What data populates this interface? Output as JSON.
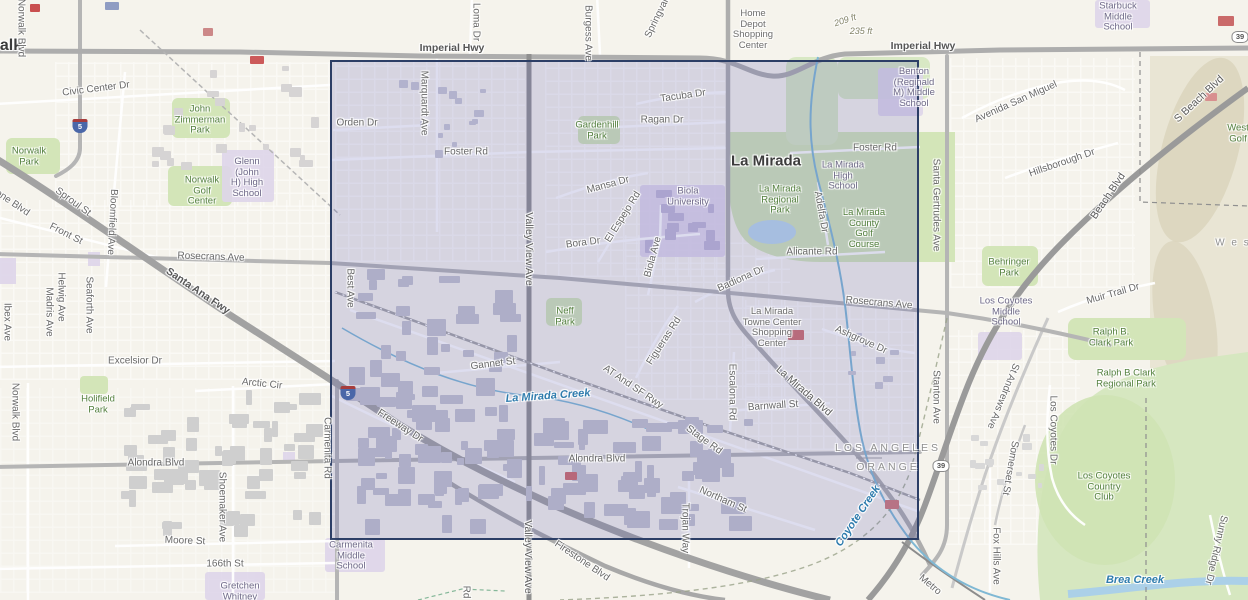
{
  "colors": {
    "selection_fill": "rgba(90,92,178,0.20)",
    "selection_border": "#2c3e66",
    "water_label": "#2f7cad",
    "park_label": "#54803f",
    "road_label": "#696969",
    "school_label": "#6f6a88",
    "park_fill": "#d3e5b8",
    "freeway": "#a2a2a2"
  },
  "selection": {
    "x": 330,
    "y": 60,
    "width": 589,
    "height": 480
  },
  "shields": [
    {
      "type": "interstate",
      "num": "5",
      "x": 80,
      "y": 126
    },
    {
      "type": "interstate",
      "num": "5",
      "x": 348,
      "y": 393
    },
    {
      "type": "state",
      "num": "39",
      "x": 941,
      "y": 466
    },
    {
      "type": "state",
      "num": "39",
      "x": 1240,
      "y": 37
    }
  ],
  "labels": [
    {
      "id": "norwalk-city",
      "text": "Norwalk",
      "x": -9,
      "y": 46,
      "kind": "city",
      "size": 16
    },
    {
      "id": "la-mirada-city",
      "text": "La Mirada",
      "x": 766,
      "y": 161,
      "kind": "city"
    },
    {
      "id": "imperial-hwy-w",
      "text": "Imperial Hwy",
      "x": 452,
      "y": 48,
      "kind": "hwy"
    },
    {
      "id": "imperial-hwy-e",
      "text": "Imperial Hwy",
      "x": 923,
      "y": 46,
      "kind": "hwy"
    },
    {
      "id": "santa-ana-fwy",
      "text": "Santa Ana Fwy",
      "x": 198,
      "y": 291,
      "rot": 34,
      "kind": "hwy"
    },
    {
      "id": "civic-center-dr",
      "text": "Civic Center Dr",
      "x": 96,
      "y": 89,
      "rot": -7,
      "kind": "road"
    },
    {
      "id": "norwalk-blvd-n",
      "text": "Norwalk Blvd",
      "x": 21,
      "y": 28,
      "rot": 90,
      "kind": "road"
    },
    {
      "id": "bloomfield-ave",
      "text": "Bloomfield Ave",
      "x": 112,
      "y": 222,
      "rot": 93,
      "kind": "road"
    },
    {
      "id": "sproul-st",
      "text": "Sproul St",
      "x": 73,
      "y": 202,
      "rot": 36,
      "kind": "road"
    },
    {
      "id": "front-st",
      "text": "Front St",
      "x": 66,
      "y": 234,
      "rot": 27,
      "kind": "road"
    },
    {
      "id": "firestone-blvd-nw",
      "text": "Firestone Blvd",
      "x": 2,
      "y": 196,
      "rot": 34,
      "kind": "road"
    },
    {
      "id": "rosecrans-ave-w",
      "text": "Rosecrans Ave",
      "x": 211,
      "y": 257,
      "rot": 2,
      "kind": "road"
    },
    {
      "id": "excelsior-dr",
      "text": "Excelsior Dr",
      "x": 135,
      "y": 361,
      "kind": "road"
    },
    {
      "id": "arctic-cir",
      "text": "Arctic Cir",
      "x": 262,
      "y": 384,
      "rot": 6,
      "kind": "road"
    },
    {
      "id": "ibex-ave",
      "text": "Ibex Ave",
      "x": 7,
      "y": 322,
      "rot": 90,
      "kind": "road"
    },
    {
      "id": "madris-ave",
      "text": "Madris Ave",
      "x": 49,
      "y": 312,
      "rot": 90,
      "kind": "road"
    },
    {
      "id": "helwig-ave",
      "text": "Helwig Ave",
      "x": 61,
      "y": 297,
      "rot": 90,
      "kind": "road"
    },
    {
      "id": "seaforth-ave",
      "text": "Seaforth Ave",
      "x": 89,
      "y": 305,
      "rot": 90,
      "kind": "road"
    },
    {
      "id": "norwalk-blvd-s",
      "text": "Norwalk Blvd",
      "x": 15,
      "y": 412,
      "rot": 90,
      "kind": "road"
    },
    {
      "id": "alondra-blvd-w",
      "text": "Alondra Blvd",
      "x": 156,
      "y": 463,
      "kind": "road"
    },
    {
      "id": "moore-st",
      "text": "Moore St",
      "x": 185,
      "y": 541,
      "rot": 2,
      "kind": "road"
    },
    {
      "id": "st-166th",
      "text": "166th St",
      "x": 225,
      "y": 564,
      "kind": "road"
    },
    {
      "id": "shoemaker-ave",
      "text": "Shoemaker Ave",
      "x": 222,
      "y": 507,
      "rot": 90,
      "kind": "road"
    },
    {
      "id": "holifield-park",
      "lines": [
        "Holifield",
        "Park"
      ],
      "x": 98,
      "y": 405,
      "kind": "park"
    },
    {
      "id": "norwalk-park",
      "lines": [
        "Norwalk",
        "Park"
      ],
      "x": 29,
      "y": 157,
      "kind": "park"
    },
    {
      "id": "zimmerman-park",
      "lines": [
        "John",
        "Zimmerman",
        "Park"
      ],
      "x": 200,
      "y": 120,
      "kind": "park"
    },
    {
      "id": "norwalk-golf-center",
      "lines": [
        "Norwalk",
        "Golf",
        "Center"
      ],
      "x": 202,
      "y": 191,
      "kind": "park"
    },
    {
      "id": "glenn-high-school",
      "lines": [
        "Glenn",
        "(John",
        "H) High",
        "School"
      ],
      "x": 247,
      "y": 178,
      "kind": "school"
    },
    {
      "id": "gretchen-whitney",
      "lines": [
        "Gretchen",
        "Whitney"
      ],
      "x": 240,
      "y": 592,
      "kind": "school"
    },
    {
      "id": "carmenita-middle-school",
      "lines": [
        "Carmenita",
        "Middle",
        "School"
      ],
      "x": 351,
      "y": 556,
      "kind": "school"
    },
    {
      "id": "carmenita-rd",
      "text": "Carmenita Rd",
      "x": 327,
      "y": 448,
      "rot": 90,
      "kind": "road"
    },
    {
      "id": "orden-dr",
      "text": "Orden Dr",
      "x": 357,
      "y": 123,
      "kind": "road"
    },
    {
      "id": "marquardt-ave",
      "text": "Marquardt Ave",
      "x": 424,
      "y": 103,
      "rot": 90,
      "kind": "road"
    },
    {
      "id": "best-ave",
      "text": "Best Ave",
      "x": 350,
      "y": 288,
      "rot": 90,
      "kind": "road"
    },
    {
      "id": "foster-rd-w",
      "text": "Foster Rd",
      "x": 466,
      "y": 152,
      "kind": "road"
    },
    {
      "id": "foster-rd-e",
      "text": "Foster Rd",
      "x": 875,
      "y": 148,
      "kind": "road"
    },
    {
      "id": "valley-view-ave-n",
      "text": "Valley View Ave",
      "x": 529,
      "y": 249,
      "rot": 90,
      "kind": "road-major"
    },
    {
      "id": "valley-view-ave-s",
      "text": "Valley View Ave",
      "x": 528,
      "y": 557,
      "rot": 90,
      "kind": "road-major"
    },
    {
      "id": "loma-dr",
      "text": "Loma Dr",
      "x": 476,
      "y": 22,
      "rot": 90,
      "kind": "road"
    },
    {
      "id": "burgess-ave",
      "text": "Burgess Ave",
      "x": 588,
      "y": 33,
      "rot": 90,
      "kind": "road"
    },
    {
      "id": "springvale-dr",
      "text": "Springvale Dr",
      "x": 661,
      "y": 10,
      "rot": -64,
      "kind": "road"
    },
    {
      "id": "tacuba-dr",
      "text": "Tacuba Dr",
      "x": 683,
      "y": 96,
      "rot": -8,
      "kind": "road"
    },
    {
      "id": "ragan-dr",
      "text": "Ragan Dr",
      "x": 662,
      "y": 120,
      "kind": "road"
    },
    {
      "id": "gardenhill-park",
      "lines": [
        "Gardenhill",
        "Park"
      ],
      "x": 597,
      "y": 131,
      "kind": "park"
    },
    {
      "id": "mansa-dr",
      "text": "Mansa Dr",
      "x": 608,
      "y": 185,
      "rot": -15,
      "kind": "road"
    },
    {
      "id": "bora-dr",
      "text": "Bora Dr",
      "x": 583,
      "y": 243,
      "rot": -7,
      "kind": "road"
    },
    {
      "id": "el-espejo-rd",
      "text": "El Espejo Rd",
      "x": 623,
      "y": 217,
      "rot": -58,
      "kind": "road"
    },
    {
      "id": "biola-ave",
      "text": "Biola Ave",
      "x": 653,
      "y": 257,
      "rot": -75,
      "kind": "road"
    },
    {
      "id": "biola-university",
      "lines": [
        "Biola",
        "University"
      ],
      "x": 688,
      "y": 197,
      "kind": "school"
    },
    {
      "id": "home-depot-sc",
      "lines": [
        "Home",
        "Depot",
        "Shopping",
        "Center"
      ],
      "x": 753,
      "y": 30,
      "kind": "poi"
    },
    {
      "id": "benton-middle-school",
      "lines": [
        "Benton",
        "(Reginald",
        "M) Middle",
        "School"
      ],
      "x": 914,
      "y": 88,
      "kind": "school"
    },
    {
      "id": "starbuck-middle-school",
      "lines": [
        "Starbuck",
        "Middle",
        "School"
      ],
      "x": 1118,
      "y": 17,
      "kind": "school"
    },
    {
      "id": "la-mirada-high-school",
      "lines": [
        "La Mirada",
        "High",
        "School"
      ],
      "x": 843,
      "y": 176,
      "kind": "school"
    },
    {
      "id": "la-mirada-regional-park",
      "lines": [
        "La Mirada",
        "Regional",
        "Park"
      ],
      "x": 780,
      "y": 200,
      "kind": "park"
    },
    {
      "id": "la-mirada-county-golf",
      "lines": [
        "La Mirada",
        "County",
        "Golf",
        "Course"
      ],
      "x": 864,
      "y": 229,
      "kind": "park"
    },
    {
      "id": "adelfa-dr",
      "text": "Adelfa Dr",
      "x": 821,
      "y": 212,
      "rot": 80,
      "kind": "road"
    },
    {
      "id": "alicante-rd",
      "text": "Alicante Rd",
      "x": 812,
      "y": 252,
      "kind": "road"
    },
    {
      "id": "badiona-dr",
      "text": "Badiona Dr",
      "x": 741,
      "y": 279,
      "rot": -24,
      "kind": "road"
    },
    {
      "id": "rosecrans-ave-e",
      "text": "Rosecrans Ave",
      "x": 879,
      "y": 303,
      "rot": 5,
      "kind": "road"
    },
    {
      "id": "santa-gertrudes-ave",
      "text": "Santa Gertrudes Ave",
      "x": 936,
      "y": 205,
      "rot": 90,
      "kind": "road"
    },
    {
      "id": "ashgrove-dr",
      "text": "Ashgrove Dr",
      "x": 861,
      "y": 340,
      "rot": 24,
      "kind": "road"
    },
    {
      "id": "la-mirada-blvd",
      "text": "La Mirada Blvd",
      "x": 804,
      "y": 391,
      "rot": 41,
      "kind": "road-major"
    },
    {
      "id": "towne-center-sc",
      "lines": [
        "La Mirada",
        "Towne Center",
        "Shopping",
        "Center"
      ],
      "x": 772,
      "y": 328,
      "kind": "poi"
    },
    {
      "id": "neff-park",
      "lines": [
        "Neff",
        "Park"
      ],
      "x": 565,
      "y": 317,
      "kind": "park"
    },
    {
      "id": "gannet-st",
      "text": "Gannet St",
      "x": 493,
      "y": 364,
      "rot": -7,
      "kind": "road"
    },
    {
      "id": "la-mirada-creek",
      "text": "La Mirada Creek",
      "x": 548,
      "y": 396,
      "rot": -4,
      "kind": "water"
    },
    {
      "id": "at-and-sf-rwy",
      "text": "AT And SF Rwy",
      "x": 633,
      "y": 387,
      "rot": 34,
      "kind": "road"
    },
    {
      "id": "figueras-rd",
      "text": "Figueras Rd",
      "x": 664,
      "y": 341,
      "rot": -57,
      "kind": "road"
    },
    {
      "id": "stage-rd",
      "text": "Stage Rd",
      "x": 704,
      "y": 440,
      "rot": 36,
      "kind": "road"
    },
    {
      "id": "escalona-rd",
      "text": "Escalona Rd",
      "x": 732,
      "y": 392,
      "rot": 90,
      "kind": "road"
    },
    {
      "id": "barnwall-st",
      "text": "Barnwall St",
      "x": 773,
      "y": 406,
      "rot": -4,
      "kind": "road"
    },
    {
      "id": "alondra-blvd-c",
      "text": "Alondra Blvd",
      "x": 597,
      "y": 459,
      "kind": "road"
    },
    {
      "id": "freeway-dr",
      "text": "Freeway Dr",
      "x": 400,
      "y": 426,
      "rot": 33,
      "kind": "road"
    },
    {
      "id": "northam-st",
      "text": "Northam St",
      "x": 723,
      "y": 500,
      "rot": 24,
      "kind": "road"
    },
    {
      "id": "trojan-way",
      "text": "Trojan Way",
      "x": 685,
      "y": 528,
      "rot": 90,
      "kind": "road"
    },
    {
      "id": "firestone-blvd-s",
      "text": "Firestone Blvd",
      "x": 582,
      "y": 561,
      "rot": 34,
      "kind": "road"
    },
    {
      "id": "rd-partial",
      "text": "Rd",
      "x": 466,
      "y": 592,
      "rot": 90,
      "kind": "road"
    },
    {
      "id": "coyote-creek",
      "text": "Coyote Creek",
      "x": 858,
      "y": 516,
      "rot": -56,
      "kind": "water"
    },
    {
      "id": "los-angeles-county",
      "text": "LOS ANGELES",
      "x": 888,
      "y": 448,
      "kind": "county"
    },
    {
      "id": "orange-county",
      "text": "ORANGE",
      "x": 888,
      "y": 467,
      "kind": "county"
    },
    {
      "id": "metro",
      "text": "Metro",
      "x": 930,
      "y": 585,
      "rot": 40,
      "kind": "road"
    },
    {
      "id": "stanton-ave",
      "text": "Stanton Ave",
      "x": 936,
      "y": 397,
      "rot": 90,
      "kind": "road"
    },
    {
      "id": "st-andrews-ave",
      "text": "St Andrews Ave",
      "x": 1003,
      "y": 396,
      "rot": 112,
      "kind": "road"
    },
    {
      "id": "somerset-st",
      "text": "Somerset St",
      "x": 1010,
      "y": 468,
      "rot": 100,
      "kind": "road"
    },
    {
      "id": "fox-hills-ave",
      "text": "Fox Hills Ave",
      "x": 996,
      "y": 556,
      "rot": 90,
      "kind": "road"
    },
    {
      "id": "los-coyotes-dr",
      "text": "Los Coyotes Dr",
      "x": 1053,
      "y": 430,
      "rot": 90,
      "kind": "road"
    },
    {
      "id": "los-coyotes-country-club",
      "lines": [
        "Los Coyotes",
        "Country",
        "Club"
      ],
      "x": 1104,
      "y": 487,
      "kind": "park"
    },
    {
      "id": "brea-creek",
      "text": "Brea Creek",
      "x": 1135,
      "y": 580,
      "kind": "water"
    },
    {
      "id": "sunny-ridge-dr",
      "text": "Sunny Ridge Dr",
      "x": 1216,
      "y": 550,
      "rot": 103,
      "kind": "road"
    },
    {
      "id": "los-coyotes-middle-school",
      "lines": [
        "Los Coyotes",
        "Middle",
        "School"
      ],
      "x": 1006,
      "y": 312,
      "kind": "school"
    },
    {
      "id": "behringer-park",
      "lines": [
        "Behringer",
        "Park"
      ],
      "x": 1009,
      "y": 268,
      "kind": "park"
    },
    {
      "id": "ralph-b-clark-park",
      "lines": [
        "Ralph B.",
        "Clark Park"
      ],
      "x": 1111,
      "y": 338,
      "kind": "park"
    },
    {
      "id": "ralph-b-clark-regional",
      "lines": [
        "Ralph B Clark",
        "Regional Park"
      ],
      "x": 1126,
      "y": 379,
      "kind": "park"
    },
    {
      "id": "muir-trail-dr",
      "text": "Muir Trail Dr",
      "x": 1113,
      "y": 294,
      "rot": -16,
      "kind": "road"
    },
    {
      "id": "hillsborough-dr",
      "text": "Hillsborough Dr",
      "x": 1062,
      "y": 163,
      "rot": -19,
      "kind": "road"
    },
    {
      "id": "avenida-san-miguel",
      "text": "Avenida San Miguel",
      "x": 1016,
      "y": 102,
      "rot": -24,
      "kind": "road"
    },
    {
      "id": "s-beach-blvd",
      "text": "S Beach Blvd",
      "x": 1199,
      "y": 99,
      "rot": -43,
      "kind": "road-major"
    },
    {
      "id": "beach-blvd",
      "text": "Beach Blvd",
      "x": 1108,
      "y": 196,
      "rot": -56,
      "kind": "road-major"
    },
    {
      "id": "west-golf",
      "lines": [
        "West",
        "Golf"
      ],
      "x": 1238,
      "y": 134,
      "kind": "park"
    },
    {
      "id": "wes-area",
      "text": "W e s",
      "x": 1233,
      "y": 243,
      "kind": "area"
    },
    {
      "id": "elev-235",
      "text": "235 ft",
      "x": 861,
      "y": 31,
      "kind": "elev"
    },
    {
      "id": "elev-209",
      "text": "209 ft",
      "x": 845,
      "y": 20,
      "rot": -18,
      "kind": "elev"
    }
  ]
}
